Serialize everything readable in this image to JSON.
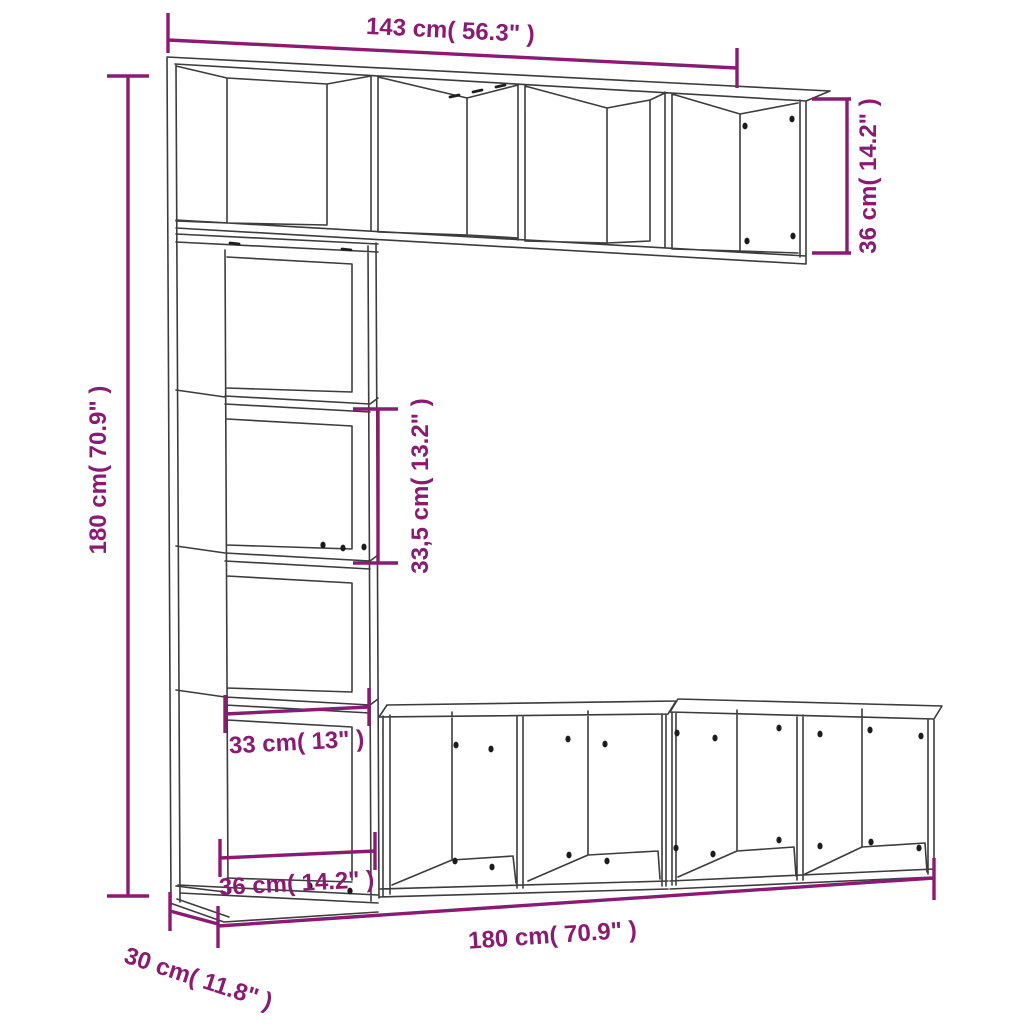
{
  "diagram": {
    "kind": "furniture dimension line drawing",
    "colors": {
      "dimension_accent": "#8B1A72",
      "outline": "#3C3C3C",
      "background": "#FFFFFF"
    },
    "dimensions": {
      "shelf_width": "143 cm( 56.3\" )",
      "shelf_height": "36 cm( 14.2\" )",
      "cabinet_height": "180 cm( 70.9\" )",
      "compartment_height": "33,5 cm( 13.2\" )",
      "compartment_width": "33 cm( 13\" )",
      "cabinet_width": "36 cm( 14.2\" )",
      "bench_width": "180 cm( 70.9\" )",
      "depth": "30 cm( 11.8\" )"
    }
  }
}
